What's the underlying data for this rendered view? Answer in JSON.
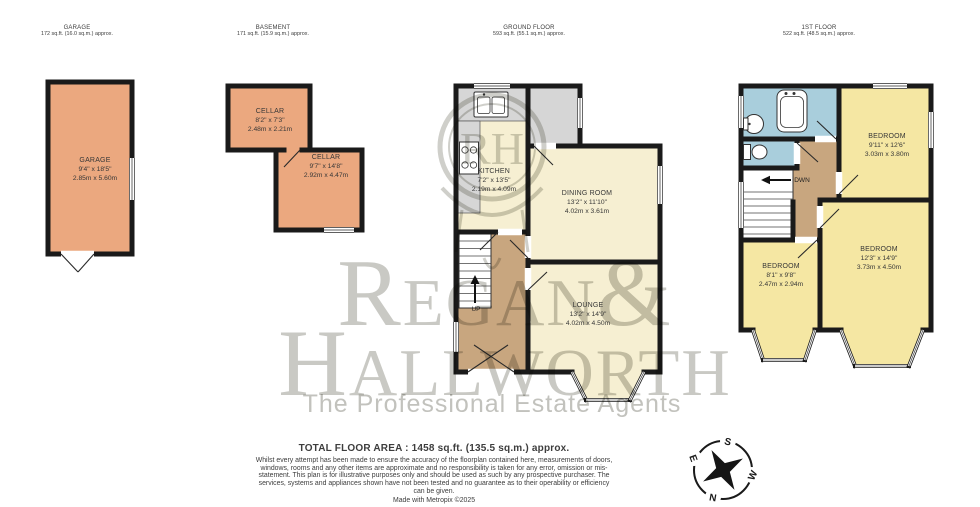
{
  "floors": {
    "garage": {
      "header": "GARAGE",
      "area": "172 sq.ft. (16.0 sq.m.) approx.",
      "rooms": [
        {
          "name": "GARAGE",
          "imperial": "9'4\" x 18'5\"",
          "metric": "2.85m x 5.60m"
        }
      ]
    },
    "basement": {
      "header": "BASEMENT",
      "area": "171 sq.ft. (15.9 sq.m.) approx.",
      "rooms": [
        {
          "name": "CELLAR",
          "imperial": "8'2\" x 7'3\"",
          "metric": "2.48m x 2.21m"
        },
        {
          "name": "CELLAR",
          "imperial": "9'7\" x 14'8\"",
          "metric": "2.92m x 4.47m"
        }
      ]
    },
    "ground": {
      "header": "GROUND FLOOR",
      "area": "593 sq.ft. (55.1 sq.m.) approx.",
      "stairs_label": "UP",
      "rooms": [
        {
          "name": "KITCHEN",
          "imperial": "7'2\" x 13'5\"",
          "metric": "2.19m x 4.09m"
        },
        {
          "name": "DINING ROOM",
          "imperial": "13'2\" x 11'10\"",
          "metric": "4.02m x 3.61m"
        },
        {
          "name": "LOUNGE",
          "imperial": "13'2\" x 14'9\"",
          "metric": "4.02m x 4.50m"
        }
      ]
    },
    "first": {
      "header": "1ST FLOOR",
      "area": "522 sq.ft. (48.5 sq.m.) approx.",
      "stairs_label": "DWN",
      "rooms": [
        {
          "name": "BEDROOM",
          "imperial": "9'11\" x 12'6\"",
          "metric": "3.03m x 3.80m"
        },
        {
          "name": "BEDROOM",
          "imperial": "12'3\" x 14'9\"",
          "metric": "3.73m x 4.50m"
        },
        {
          "name": "BEDROOM",
          "imperial": "8'1\" x 9'8\"",
          "metric": "2.47m x 2.94m"
        }
      ]
    }
  },
  "watermark": {
    "monogram": "RH",
    "brand_line1": "Regan&",
    "brand_line2": "Hallworth",
    "tagline": "The Professional Estate Agents"
  },
  "compass": {
    "north": "N",
    "south": "S",
    "east": "E",
    "west": "W"
  },
  "footer": {
    "total_area": "TOTAL FLOOR AREA : 1458 sq.ft. (135.5 sq.m.) approx.",
    "disclaimer": "Whilst every attempt has been made to ensure the accuracy of the floorplan contained here, measurements of doors, windows, rooms and any other items are approximate and no responsibility is taken for any error, omission or mis-statement. This plan is for illustrative purposes only and should be used as such by any prospective purchaser. The services, systems and appliances shown have not been tested and no guarantee as to their operability or efficiency can be given.",
    "credit": "Made with Metropix ©2025"
  },
  "colors": {
    "wall": "#1a1a1a",
    "garage_fill": "#eba87f",
    "room_cream": "#f6efd2",
    "bedroom_yellow": "#f5e7a3",
    "bath_blue": "#a9cedc",
    "hall_tan": "#c8a67f",
    "counter_gray": "#d6d6d6",
    "watermark_gray": "#c9c9c4"
  }
}
